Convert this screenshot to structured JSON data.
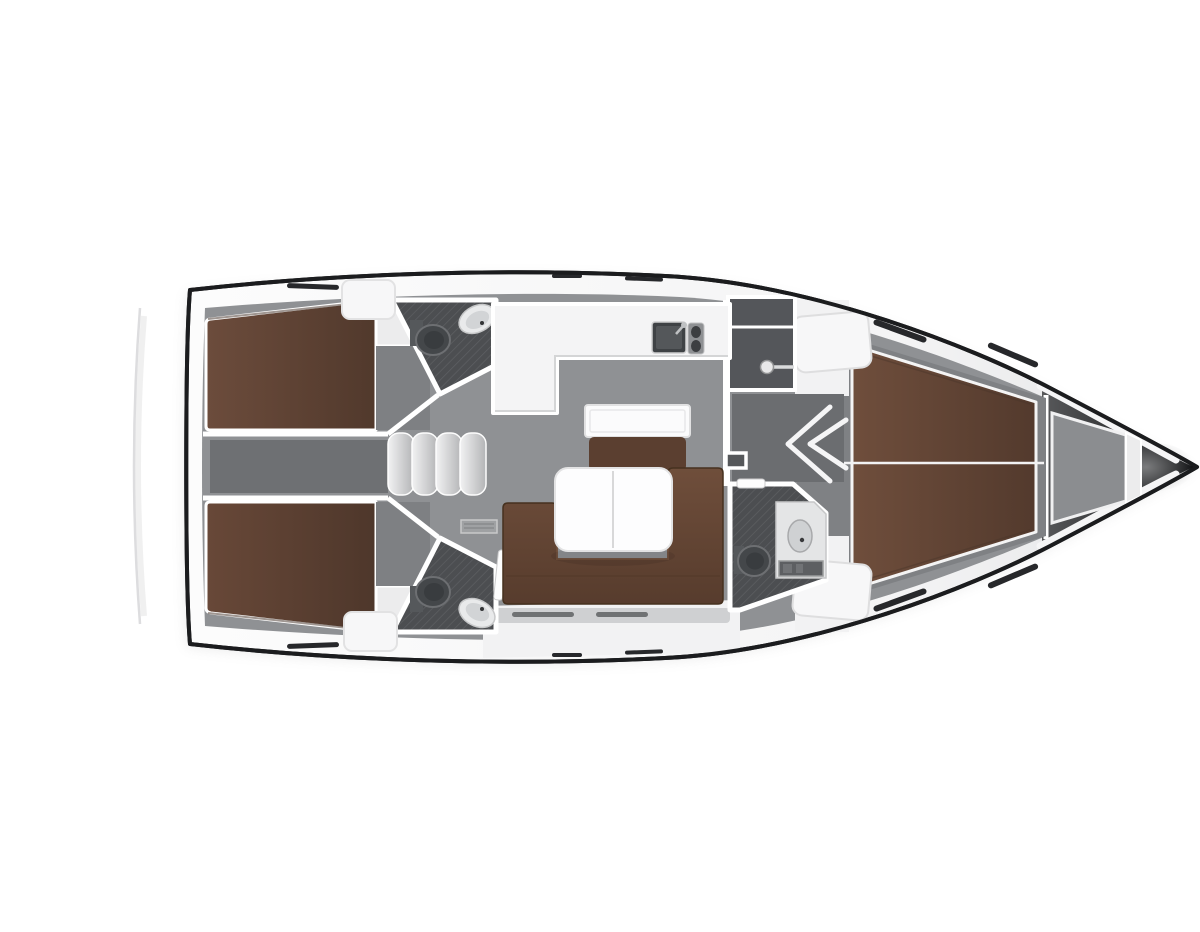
{
  "title": "Sailing yacht interior layout — top-view floor plan",
  "canvas": {
    "width": 1200,
    "height": 900
  },
  "palette": {
    "pageBg": "#ffffff",
    "hullOutline": "#1b1c1e",
    "deckWhite": "#fafafa",
    "deckShade": "#e6e7e8",
    "floorGray": "#8f9194",
    "floorDark": "#6e7073",
    "corridorGray": "#6b6d70",
    "cabinFloor": "#7f8184",
    "headFloor": "#4c4e51",
    "headHatchLine": "#5e6063",
    "darkLocker": "#54565a",
    "berthAft": "#604437",
    "berthFwd": "#64483a",
    "sofaBrown": "#6b4b39",
    "seatBrown": "#5b3f30",
    "tableWhite": "#fdfdfe",
    "counterWhite": "#f4f4f5",
    "fixtureWhite": "#ededee",
    "fixtureGray": "#cfd1d3",
    "wallWhite": "#ffffff",
    "slitDark": "#27282b",
    "bowDark": "#151617",
    "bowMid": "#4b4c4e",
    "anchorGray": "#8b8d90",
    "stepLight": "#f0f0f1",
    "stepDark": "#b6b7b9"
  },
  "regions": {
    "hull": "Hull and side decks",
    "aftCabinPort": "Aft double cabin (port)",
    "aftCabinStarboard": "Aft double cabin (starboard)",
    "aftCorridor": "Aft corridor under cockpit",
    "companionway": "Companionway steps",
    "aftHeadPort": "Aft head with toilet and sink (port)",
    "aftHeadStarboard": "Aft head with toilet and sink (starboard)",
    "galley": "L-shaped galley with sink and stove",
    "saloon": "Saloon with L-sofa and folding table",
    "chartTable": "Chart table with seat",
    "wardrobe": "Hanging locker with clothes rod",
    "forwardCorridor": "Passage to forward cabin",
    "forwardHead": "Forward head with shower",
    "forwardCabin": "Forward double cabin (V-berth)",
    "anchorLocker": "Anchor locker",
    "bow": "Bow"
  }
}
